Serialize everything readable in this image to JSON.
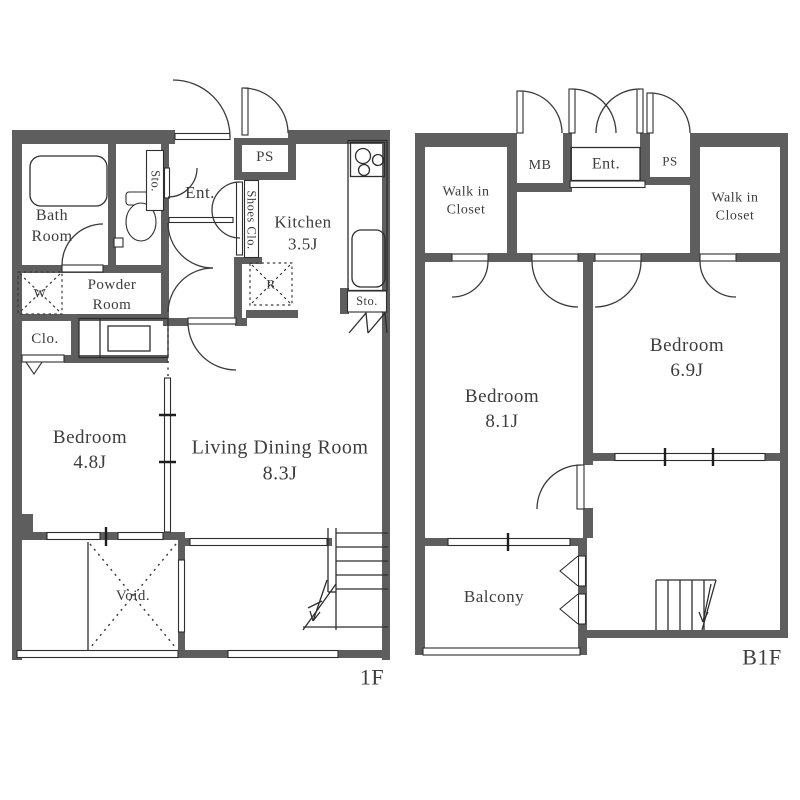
{
  "document_type": "apartment floor plan",
  "palette": {
    "wall_color": "#5e5e5e",
    "line_color": "#2e2e2e",
    "label_color": "#3d3d3d",
    "background": "#ffffff"
  },
  "f1": {
    "floor_label": "1F",
    "bath_l1": "Bath",
    "bath_l2": "Room",
    "sto_toilet": "Sto.",
    "ent": "Ent.",
    "shoes_clo": "Shoes Clo.",
    "ps": "PS",
    "kitchen_l1": "Kitchen",
    "kitchen_l2": "3.5J",
    "powder_l1": "Powder",
    "powder_l2": "Room",
    "washer": "W",
    "clo": "Clo.",
    "fridge": "R",
    "sto_kitchen": "Sto.",
    "bedroom_l1": "Bedroom",
    "bedroom_l2": "4.8J",
    "ldr_l1": "Living Dining Room",
    "ldr_l2": "8.3J",
    "void": "Void."
  },
  "b1f": {
    "floor_label": "B1F",
    "wic_left_l1": "Walk in",
    "wic_left_l2": "Closet",
    "mb": "MB",
    "ent": "Ent.",
    "ps": "PS",
    "wic_right_l1": "Walk in",
    "wic_right_l2": "Closet",
    "bedroom81_l1": "Bedroom",
    "bedroom81_l2": "8.1J",
    "bedroom69_l1": "Bedroom",
    "bedroom69_l2": "6.9J",
    "balcony": "Balcony"
  }
}
